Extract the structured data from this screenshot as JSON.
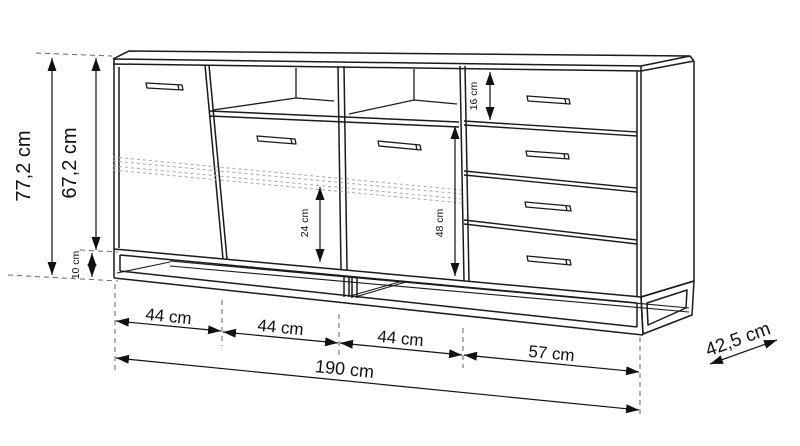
{
  "diagram": {
    "background": "#ffffff",
    "line_color": "#1a1a1a",
    "dim_color": "#111111",
    "hidden_line_color": "#a8a8a8",
    "dimensions": {
      "total_height": "77,2 cm",
      "body_height": "67,2 cm",
      "plinth_height": "10 cm",
      "top_drawer_height": "16 cm",
      "left_inner_height": "24 cm",
      "right_inner_height": "48 cm",
      "section_widths": [
        "44 cm",
        "44 cm",
        "44 cm",
        "57 cm"
      ],
      "total_width": "190 cm",
      "depth": "42,5 cm"
    }
  }
}
